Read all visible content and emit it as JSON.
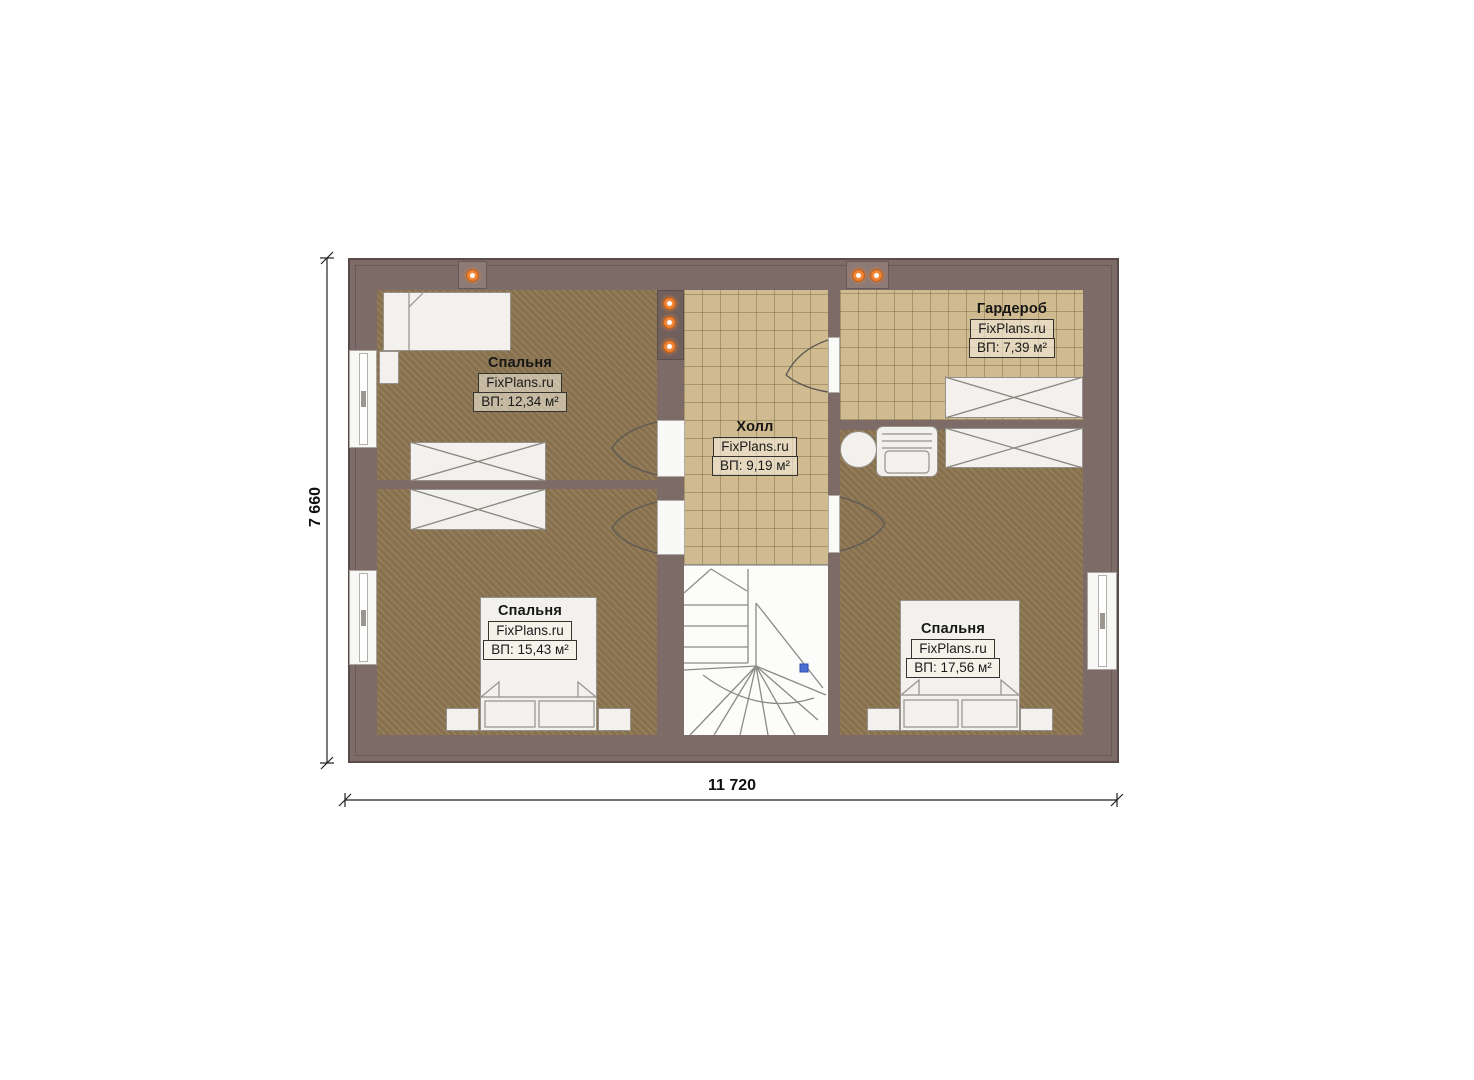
{
  "watermark": "FixPlans.ru",
  "dimensions": {
    "width_label": "11 720",
    "height_label": "7 660"
  },
  "rooms": [
    {
      "name": "Спальня",
      "area": "ВП: 12,34 м²"
    },
    {
      "name": "Холл",
      "area": "ВП: 9,19 м²"
    },
    {
      "name": "Гардероб",
      "area": "ВП: 7,39 м²"
    },
    {
      "name": "Спальня",
      "area": "ВП: 15,43 м²"
    },
    {
      "name": "Спальня",
      "area": "ВП: 17,56 м²"
    }
  ],
  "colors": {
    "wall": "#7d6b68",
    "bedroom_floor": "#8d7651",
    "tile_floor": "#d0bb91",
    "lamp_orange": "#f08231",
    "stair_marker_blue": "#4a6fd4"
  }
}
